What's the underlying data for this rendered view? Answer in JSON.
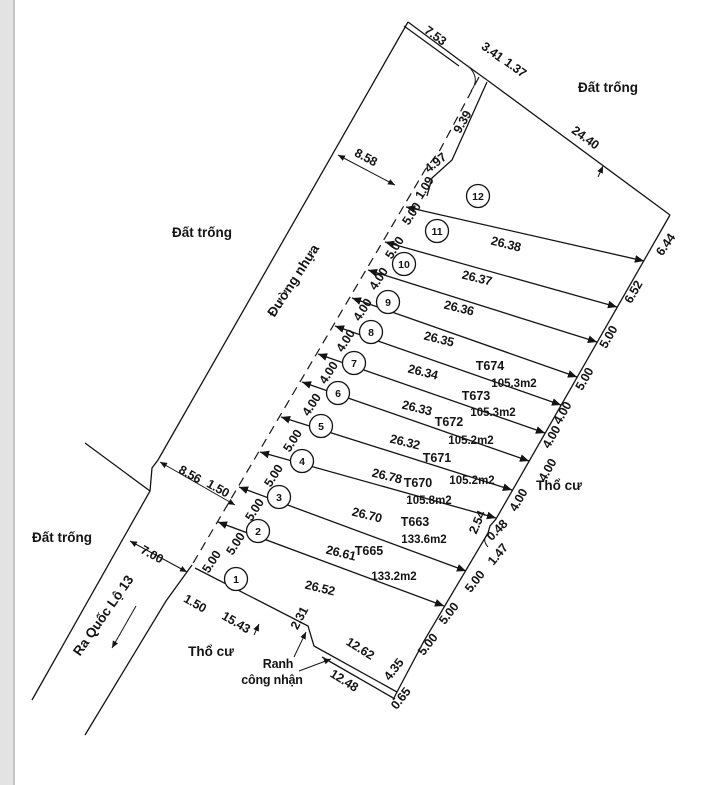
{
  "regions": {
    "empty_top_right": "Đất trống",
    "empty_mid_left": "Đất trống",
    "empty_bottom_left": "Đất trống",
    "road": "Đường nhựa",
    "to_highway": "Ra Quốc Lộ 13",
    "residential_bottom": "Thổ cư",
    "residential_right": "Thổ cư",
    "boundary_note_1": "Ranh",
    "boundary_note_2": "công nhận"
  },
  "plot_numbers": [
    "12",
    "11",
    "10",
    "9",
    "8",
    "7",
    "6",
    "5",
    "4",
    "3",
    "2",
    "1"
  ],
  "divider_lengths": [
    "26.38",
    "26.37",
    "26.36",
    "26.35",
    "26.34",
    "26.33",
    "26.32",
    "26.78",
    "26.70",
    "26.61",
    "26.52"
  ],
  "parcels": [
    {
      "id": "T674",
      "area": "105.3m2"
    },
    {
      "id": "T673",
      "area": "105.3m2"
    },
    {
      "id": "T672",
      "area": "105.2m2"
    },
    {
      "id": "T671",
      "area": "105.2m2"
    },
    {
      "id": "T670",
      "area": "105.8m2"
    },
    {
      "id": "T663",
      "area": "133.6m2"
    },
    {
      "id": "T665",
      "area": "133.2m2"
    }
  ],
  "front_widths": [
    "5.00",
    "5.00",
    "4.00",
    "4.00",
    "4.00",
    "4.00",
    "4.00",
    "5.00",
    "5.00",
    "5.00",
    "5.00",
    "5.00"
  ],
  "rear_widths": [
    "6.44",
    "6.52",
    "5.00",
    "5.00",
    "4.00",
    "4.00",
    "4.00",
    "4.00",
    "2.54",
    "0.48",
    "1.47",
    "5.00",
    "5.00",
    "5.00",
    "4.35",
    "0.65"
  ],
  "top_measures": [
    "7.53",
    "3.41",
    "1.37",
    "24.40",
    "9.39",
    "4.97",
    "1.09"
  ],
  "dims": {
    "road_width_top": "8.58",
    "jog_width": "8.56",
    "jog_offset": "1.50",
    "road_width_bottom": "7.00",
    "front_offset": "1.50",
    "bottom_1": "15.43",
    "bottom_gap": "2.31",
    "bottom_2": "12.62",
    "recognized_len": "12.48",
    "rear_tail_1": "4.35",
    "rear_tail_2": "0.65"
  }
}
